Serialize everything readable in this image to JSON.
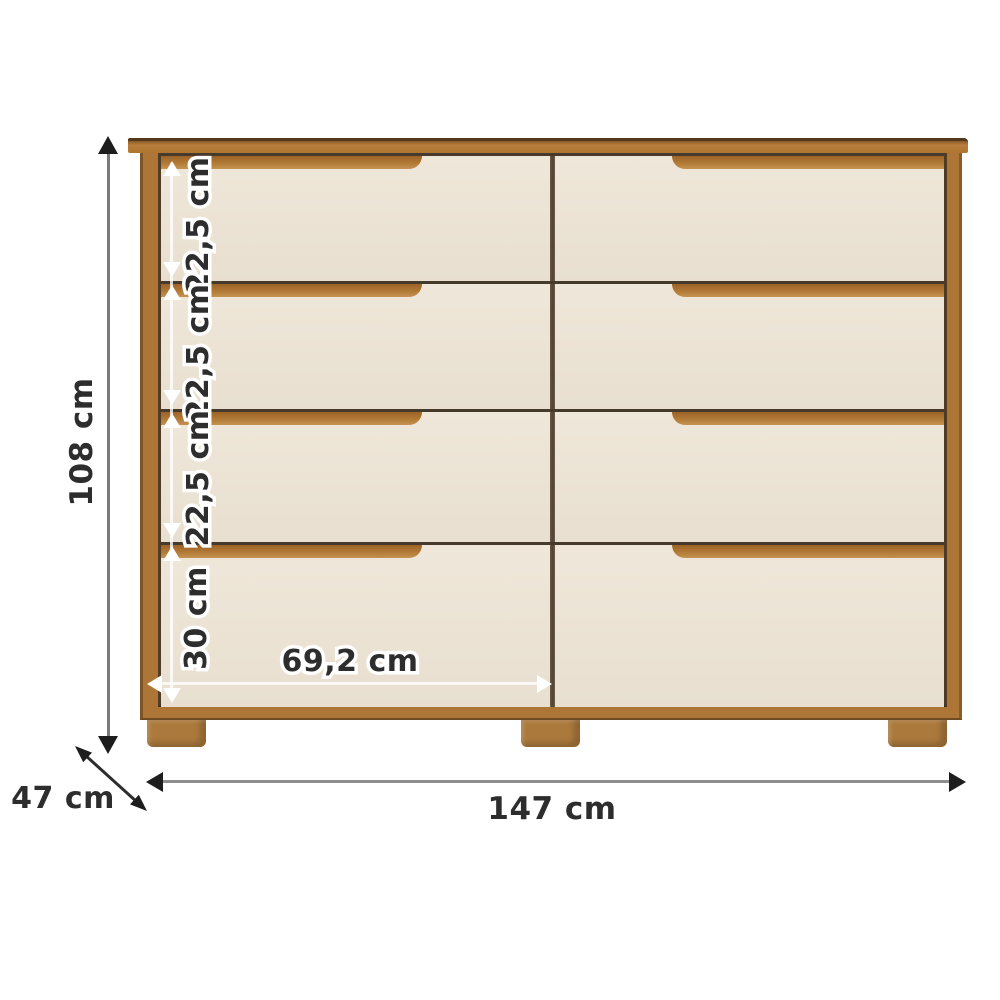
{
  "page": {
    "type": "furniture-dimension-diagram",
    "background": "#ffffff"
  },
  "furniture": {
    "name": "eight-drawer dresser",
    "drawer_rows": 4,
    "drawer_columns": 2,
    "legs": 3,
    "colors": {
      "wood": "#b0752f",
      "wood_light": "#c59350",
      "wood_dark": "#53381b",
      "drawer_front": "#ece4d6",
      "gap_line": "#463a2c",
      "dimension_text": "#2d2d2d",
      "dimension_white": "#ffffff"
    }
  },
  "dimensions": {
    "height": {
      "label": "108 cm"
    },
    "width": {
      "label": "147 cm"
    },
    "depth": {
      "label": "47 cm"
    },
    "drawer_width": {
      "label": "69,2 cm"
    },
    "row_heights": [
      {
        "label": "22,5 cm"
      },
      {
        "label": "22,5 cm"
      },
      {
        "label": "22,5 cm"
      },
      {
        "label": "30 cm"
      }
    ]
  }
}
